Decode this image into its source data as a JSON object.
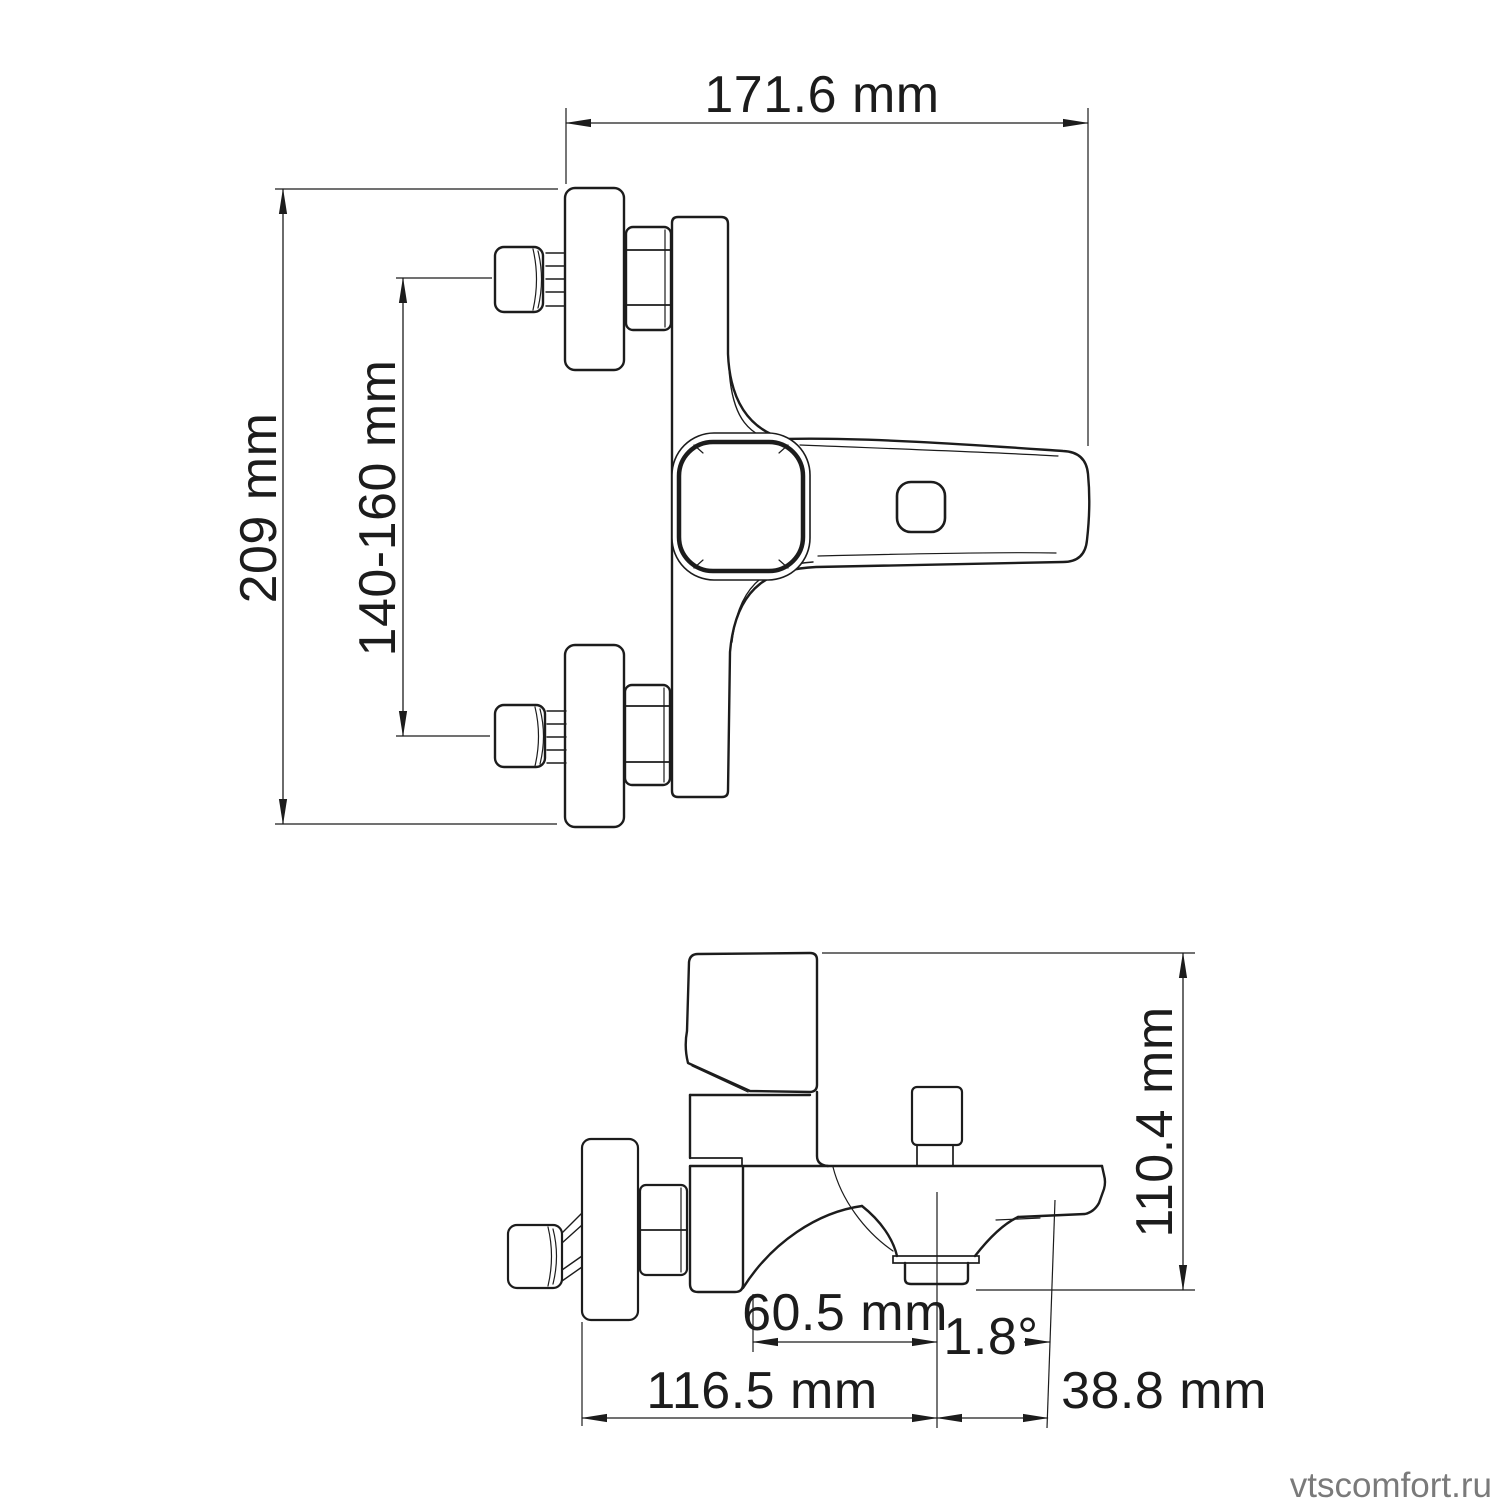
{
  "page": {
    "background": "#ffffff"
  },
  "drawing": {
    "colors": {
      "line": "#1c1c1c",
      "watermark_gray": "#7a7a7a"
    },
    "front_view": {
      "dimensions": {
        "overall_width": "171.6 mm",
        "overall_height": "209 mm",
        "inlet_spacing": "140-160 mm"
      }
    },
    "side_view": {
      "dimensions": {
        "overall_height": "110.4 mm",
        "body_to_aerator_center": "60.5 mm",
        "spout_angle": "1.8°",
        "wall_to_aerator_center": "116.5 mm",
        "aerator_center_to_tip": "38.8 mm"
      }
    },
    "watermark": "vtscomfort.ru"
  }
}
